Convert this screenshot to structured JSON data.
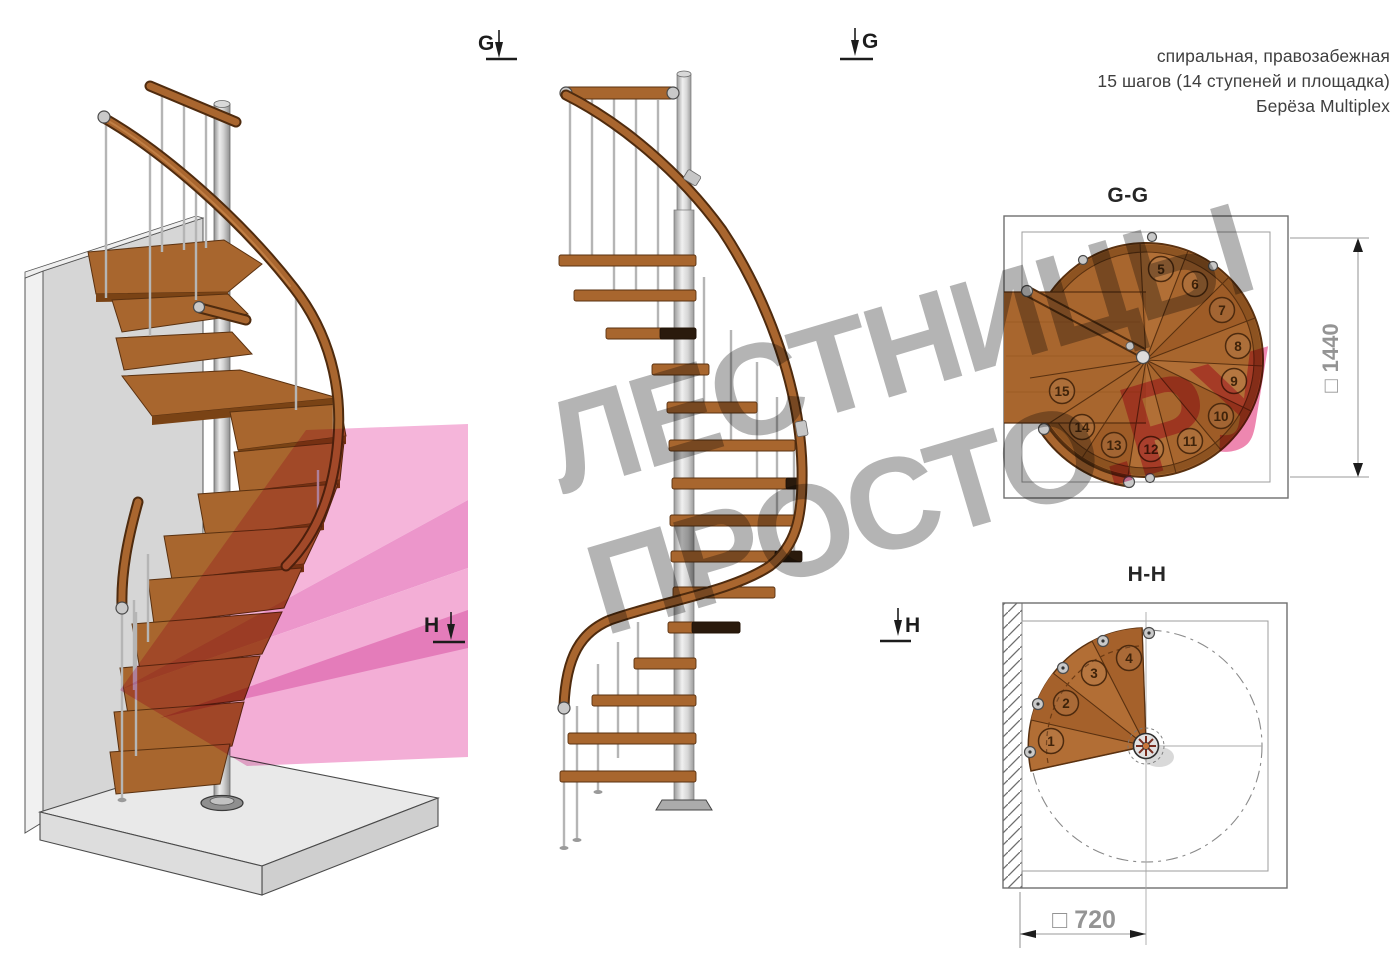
{
  "header": {
    "line1": "спиральная, правозабежная",
    "line2": "15 шагов (14 ступеней и площадка)",
    "line3": "Берёза Multiplex"
  },
  "markers": {
    "g": "G",
    "h": "H"
  },
  "watermark": {
    "line1": "ЛЕСТНИЦЫ",
    "line2_gray": "ПРОСТО",
    "line2_pink": ".РУ"
  },
  "plans": {
    "gg": {
      "title": "G-G",
      "dim_symbol": "□",
      "dim_value": "1440",
      "steps": [
        "5",
        "6",
        "7",
        "8",
        "9",
        "10",
        "11",
        "12",
        "13",
        "14",
        "15"
      ]
    },
    "hh": {
      "title": "H-H",
      "dim_symbol": "□",
      "dim_value": "720",
      "steps": [
        "1",
        "2",
        "3",
        "4"
      ]
    }
  },
  "colors": {
    "wood": "#a8662e",
    "wood_dark": "#5a3110",
    "metal": "#c9c9c9",
    "highlight_pink": "#f0a0cf",
    "watermark_gray": "#b4b4b4",
    "watermark_pink": "#ee87b0",
    "dimension_gray": "#949494"
  }
}
